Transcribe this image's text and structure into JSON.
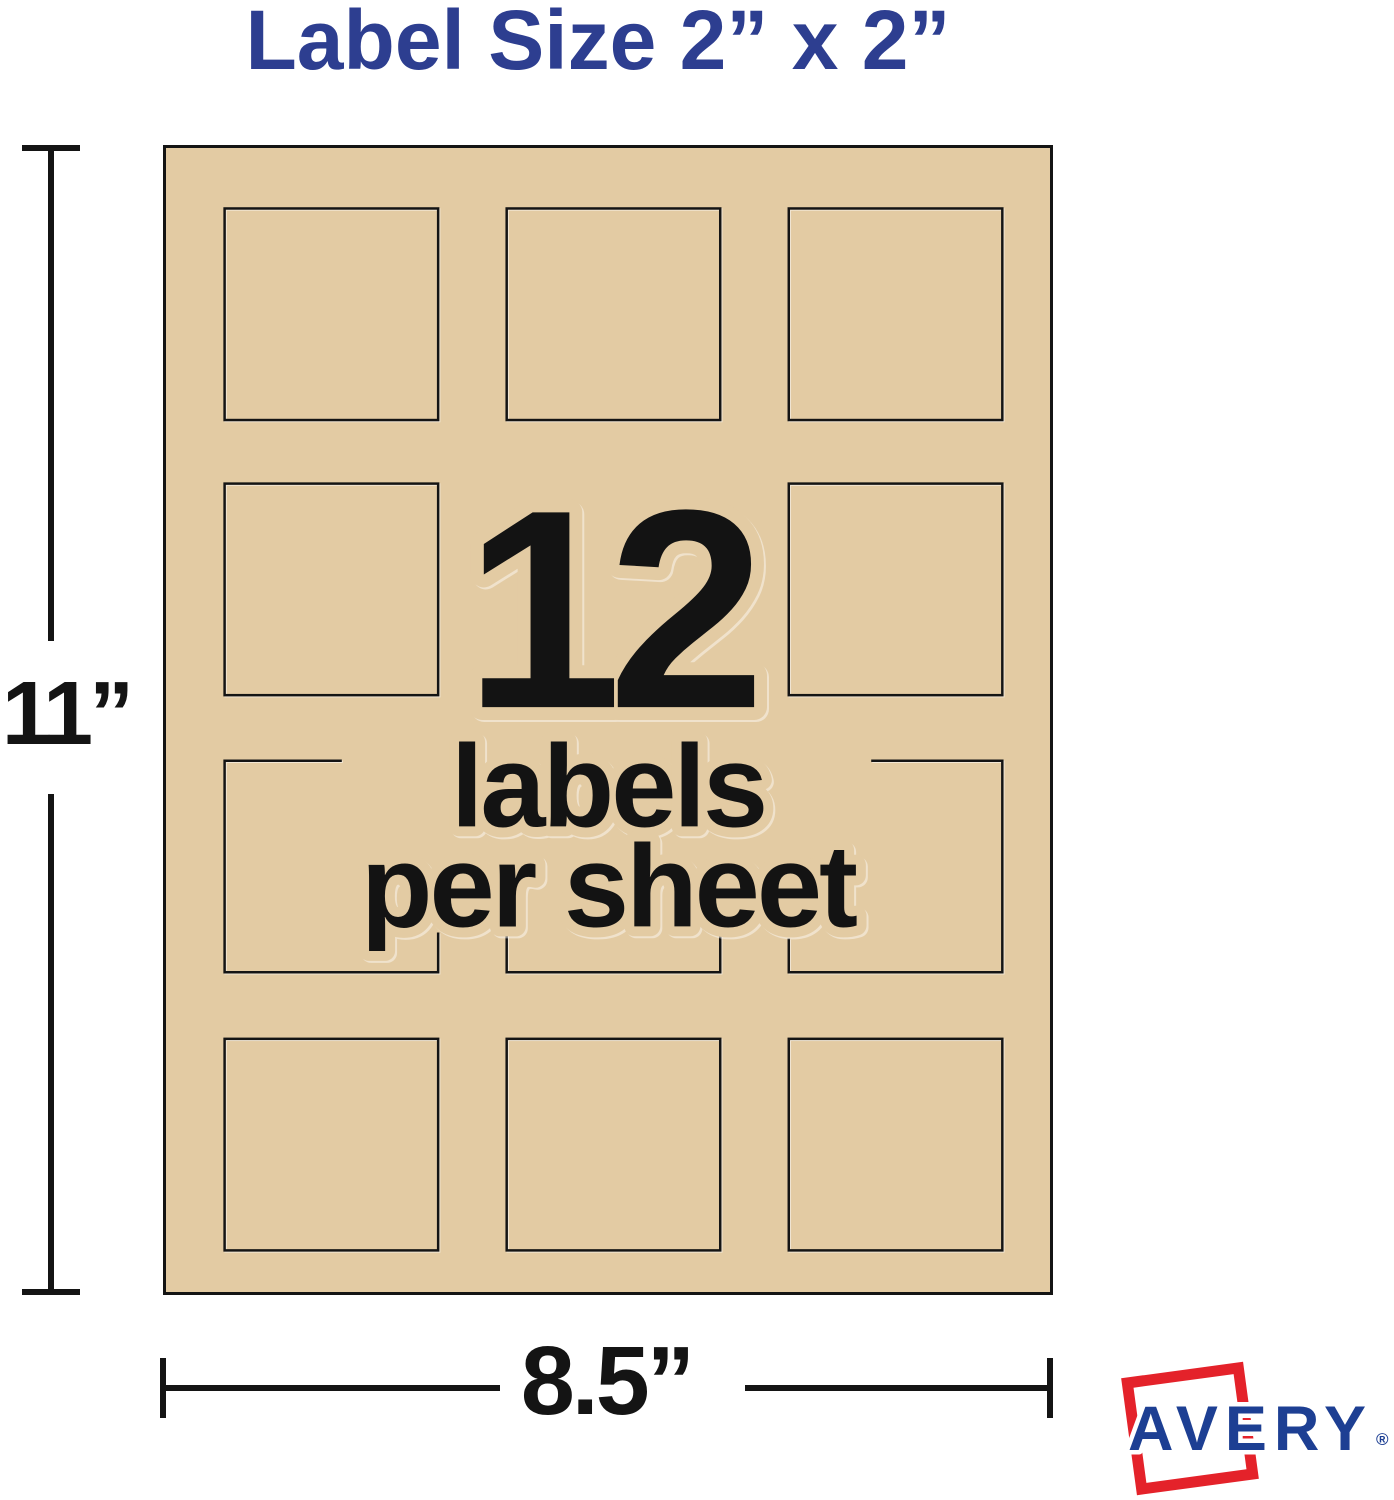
{
  "title": "Label Size 2” x 2”",
  "sheet": {
    "count": "12",
    "count_caption_line1": "labels",
    "count_caption_line2": "per sheet",
    "grid_rows": 4,
    "grid_cols": 3
  },
  "dimensions": {
    "height_label": "11”",
    "width_label": "8.5”"
  },
  "logo": {
    "brand": "AVERY",
    "registered_mark": "®"
  },
  "colors": {
    "sheet_tan": "#e3cba3",
    "ink": "#141414",
    "title_blue": "#2d3e90",
    "avery_blue": "#1d3f93",
    "avery_red": "#e4222a"
  }
}
